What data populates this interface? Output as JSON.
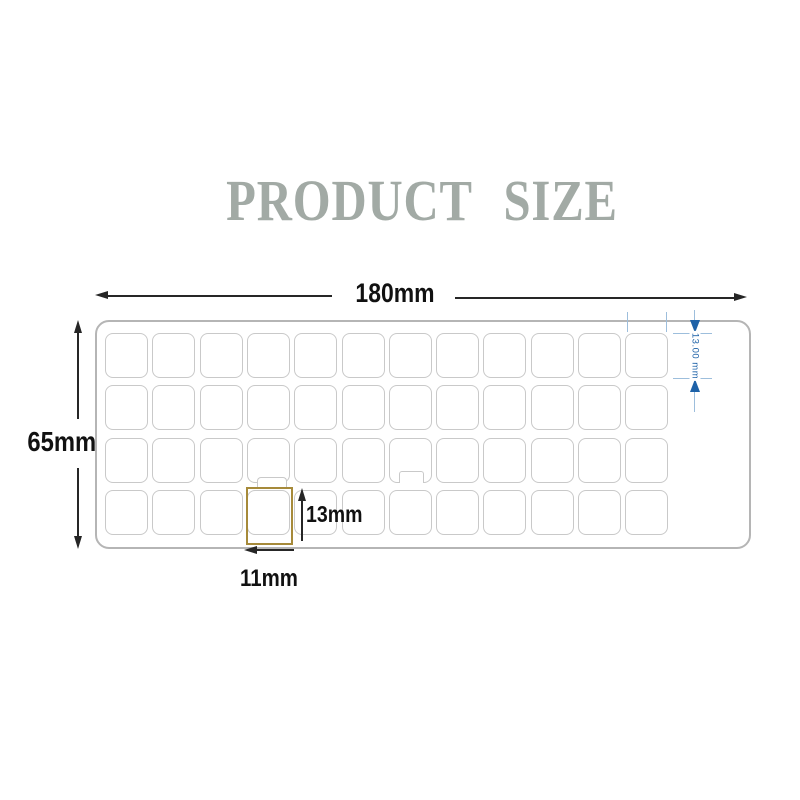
{
  "title": "PRODUCT SIZE",
  "colors": {
    "title": "#a2aaa5",
    "sheet_border": "#b5b5b5",
    "cell_border": "#c9c9c9",
    "highlight": "#a68a3a",
    "dimension_black": "#262626",
    "dimension_blue": "#1e62a8",
    "dimension_blue_light": "#9dbedc"
  },
  "dimensions": {
    "sheet_width": "180mm",
    "sheet_height": "65mm",
    "cell_height": "13mm",
    "cell_width": "11mm",
    "cell_height_detail": "13.00 mm"
  },
  "grid": {
    "rows": 4,
    "cols": 12,
    "total_cells": 48,
    "highlight_cell": {
      "row": 4,
      "col": 4
    }
  }
}
